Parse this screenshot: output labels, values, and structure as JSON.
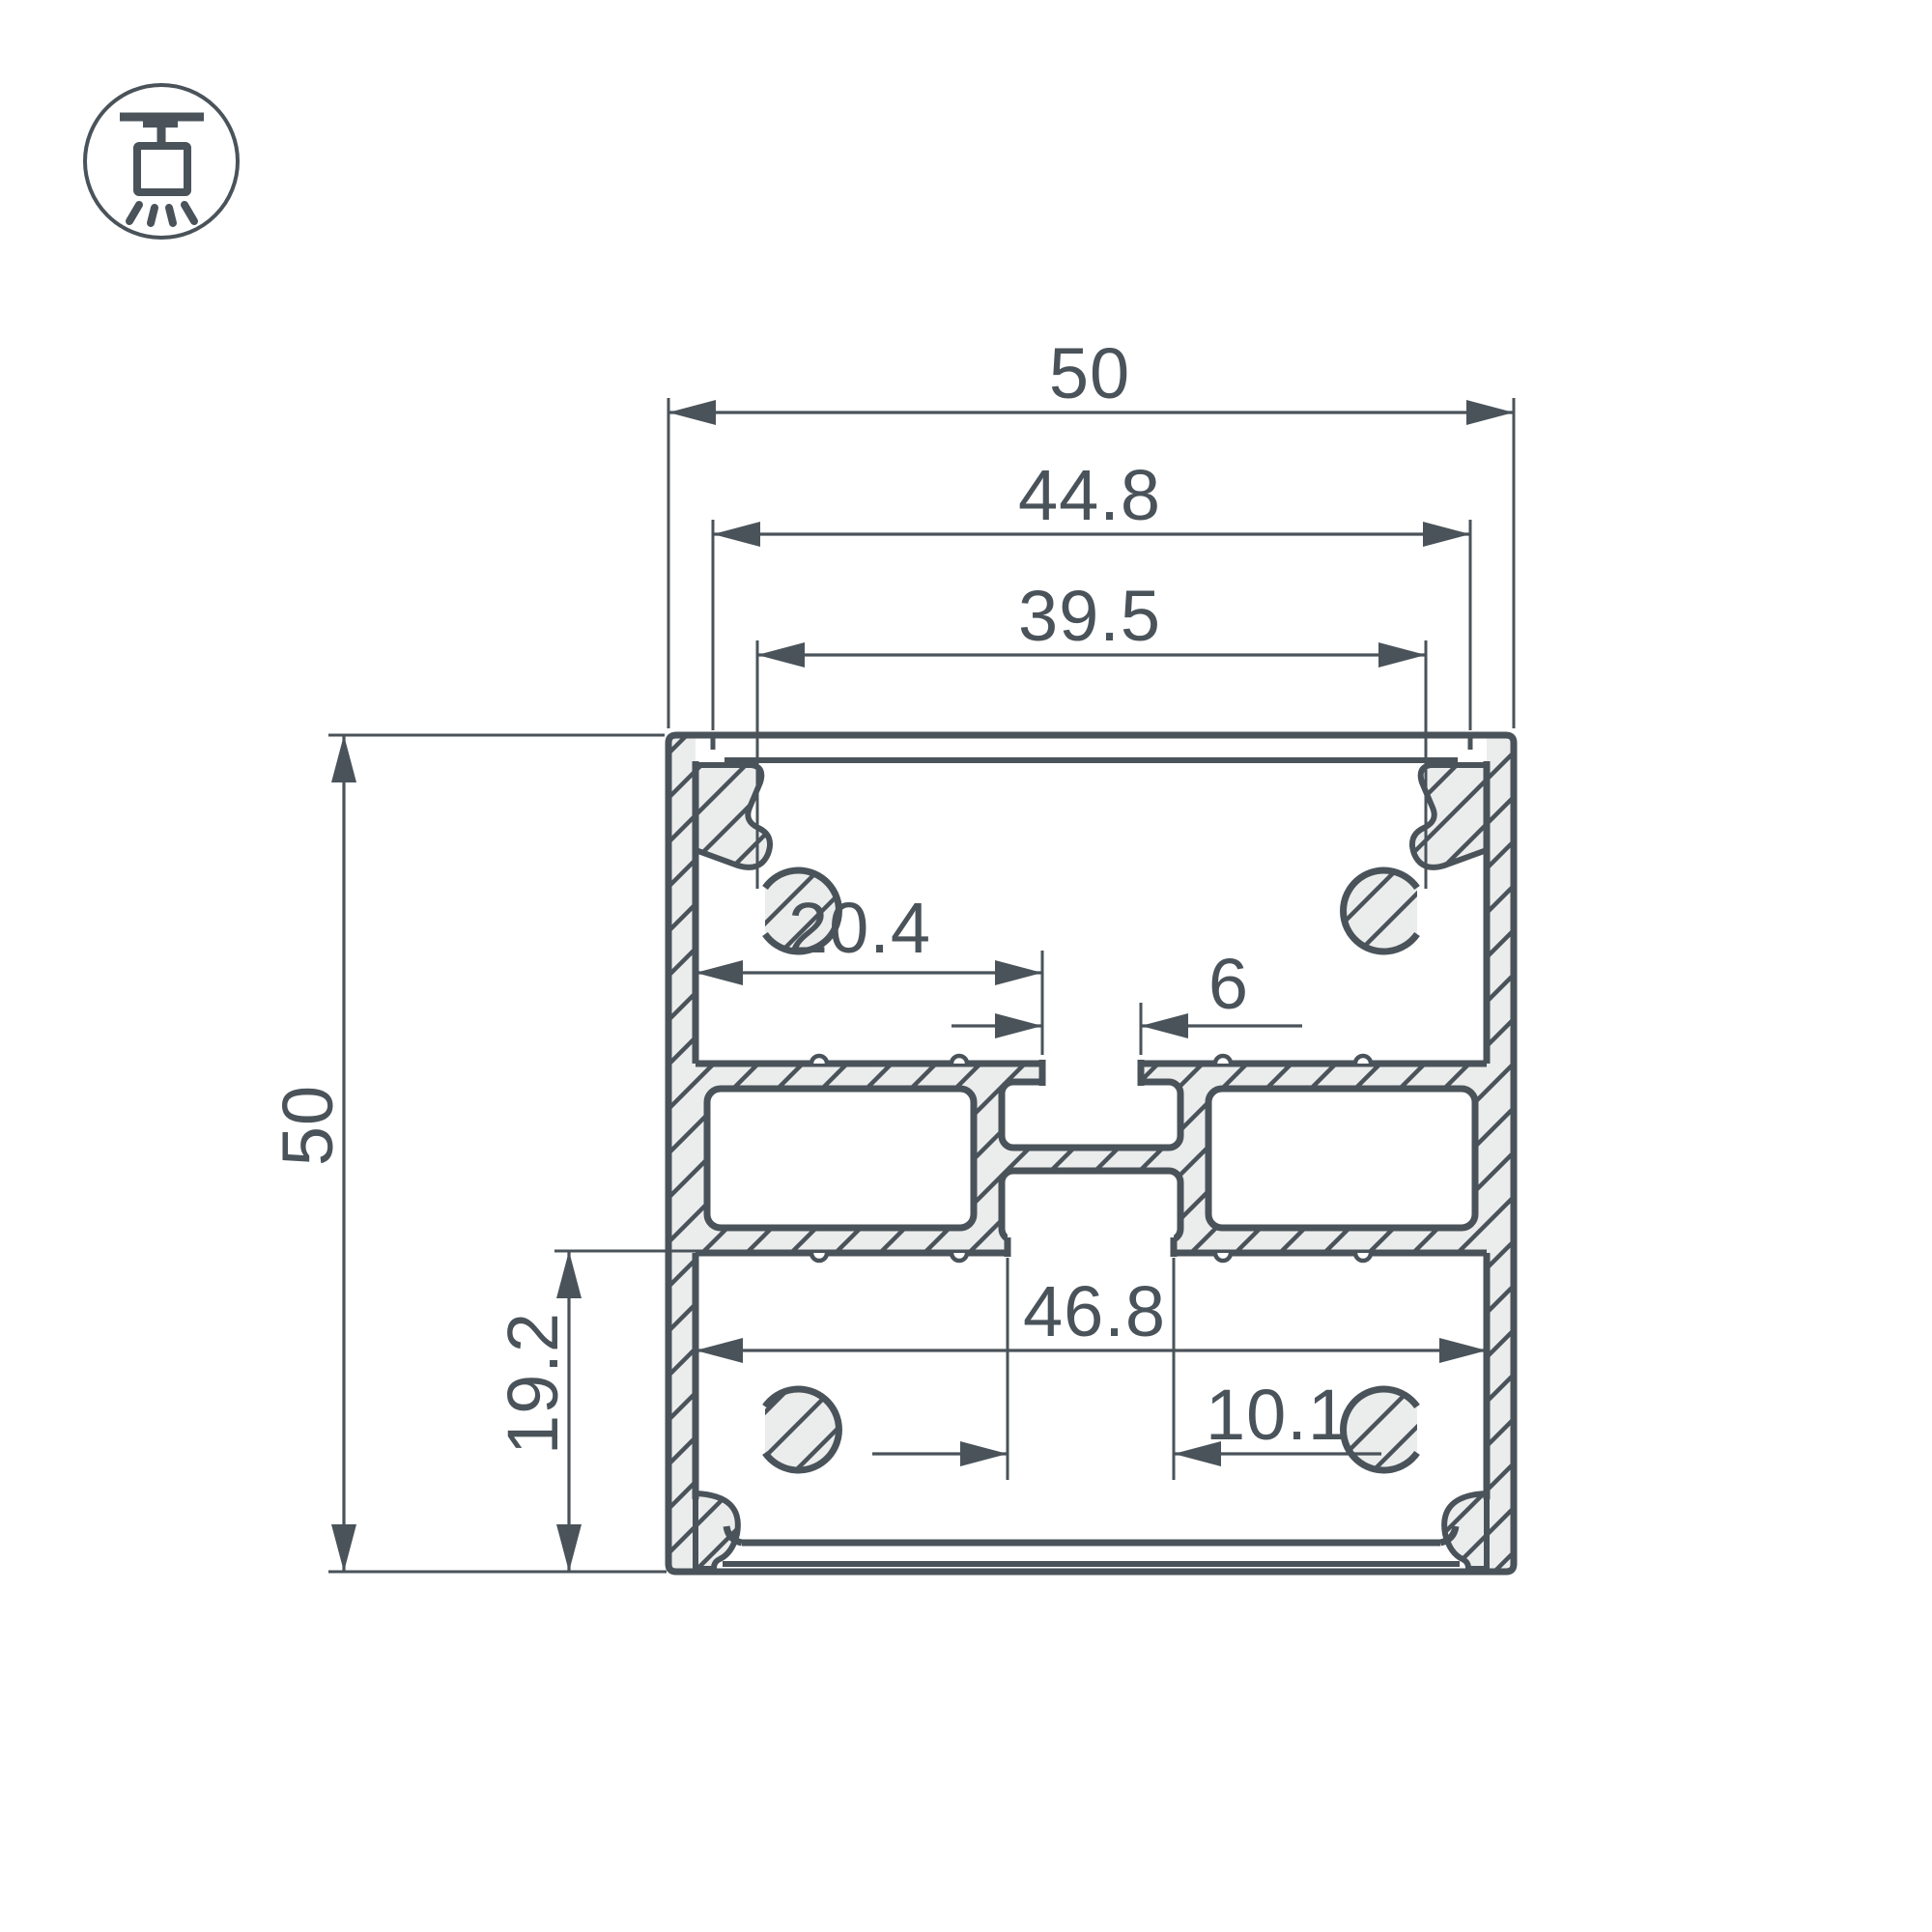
{
  "page": {
    "background": "#ffffff"
  },
  "colors": {
    "line": "#4a535a",
    "aluminum_fill": "#ebecec",
    "text": "#4a535a",
    "white": "#ffffff"
  },
  "icon": {
    "name": "surface-ceiling-mount-icon",
    "meaning": "surface / pendant mounting luminaire"
  },
  "drawing": {
    "type": "technical-cross-section",
    "subject": "aluminum LED profile cross-section with dimensions",
    "units": "mm",
    "dimensions": {
      "outer_width": "50",
      "cover_width": "44.8",
      "opening_width": "39.5",
      "shelf_offset": "20.4",
      "top_slot_width": "6",
      "inner_width": "46.8",
      "bottom_slot_width": "10.1",
      "outer_height": "50",
      "lower_section_height": "19.2"
    }
  }
}
